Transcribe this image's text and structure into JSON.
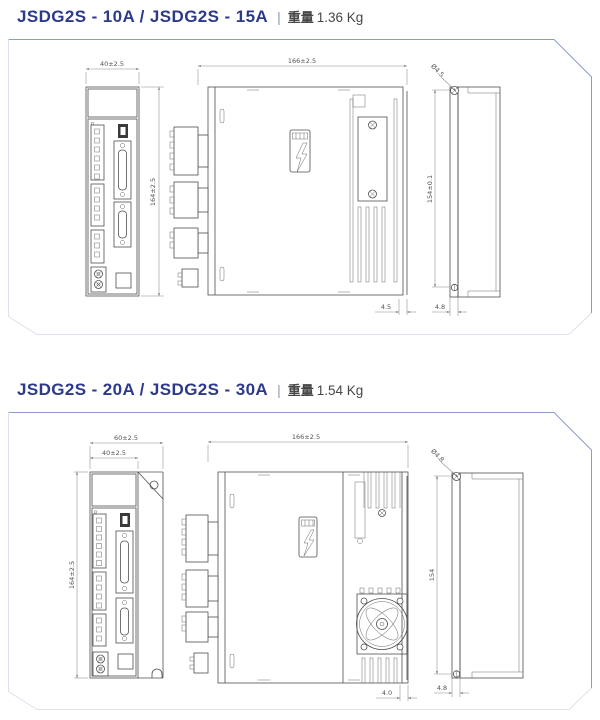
{
  "colors": {
    "title_navy": "#2d3a8a",
    "panel_border": "#8c9cc9",
    "drawing_line": "#4f4f4f",
    "dimension_text": "#555555"
  },
  "sections": [
    {
      "id": "jsdg2s-10a-15a",
      "model_title": "JSDG2S - 10A / JSDG2S - 15A",
      "separator": "|",
      "weight_label": "重量",
      "weight_value": "1.36 Kg",
      "dims": {
        "front_width": "40±2.5",
        "front_height": "164±2.5",
        "side_width": "166±2.5",
        "side_bottom_gap": "4.5",
        "mount_hole": "Ø4.5",
        "mount_pitch": "154±0.1",
        "mount_tab": "4.8"
      }
    },
    {
      "id": "jsdg2s-20a-30a",
      "model_title": "JSDG2S - 20A / JSDG2S - 30A",
      "separator": "|",
      "weight_label": "重量",
      "weight_value": "1.54 Kg",
      "dims": {
        "front_width_outer": "60±2.5",
        "front_width": "40±2.5",
        "front_height": "164±2.5",
        "side_width": "166±2.5",
        "side_bottom_gap": "4.0",
        "mount_hole": "Ø4.8",
        "mount_pitch": "154",
        "mount_tab": "4.8"
      }
    }
  ]
}
